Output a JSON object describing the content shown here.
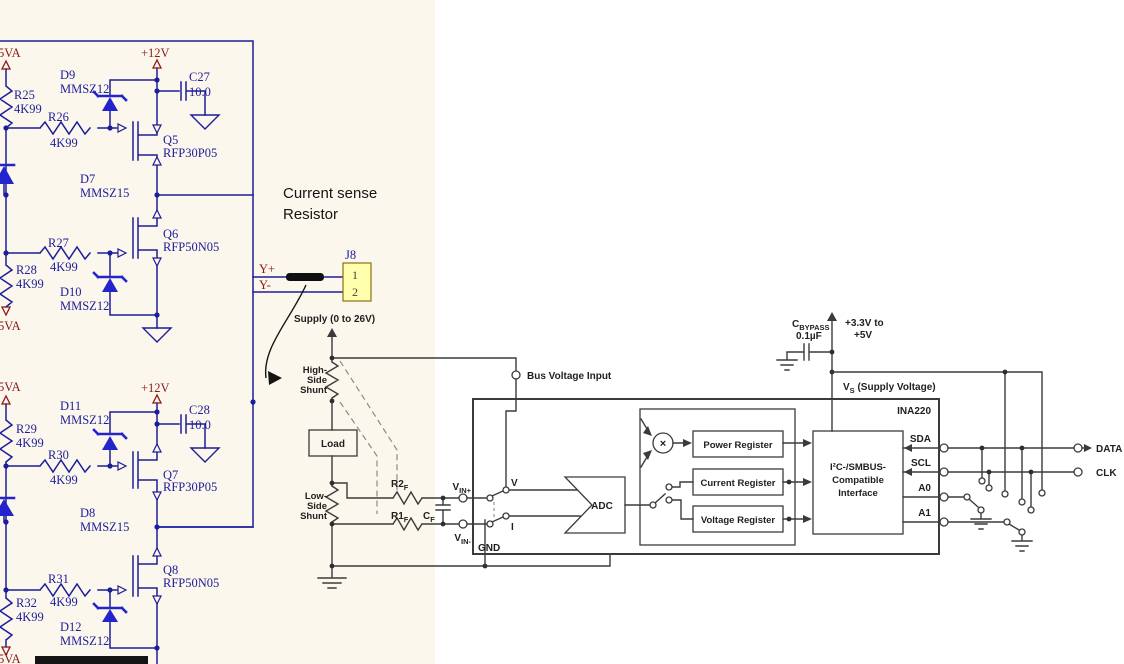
{
  "annotation": {
    "line1": "Current sense",
    "line2": "Resistor"
  },
  "left": {
    "upper": {
      "pwr_top": "5VA",
      "pwr_bottom": "5VA",
      "rail": "+12V",
      "r25_ref": "R25",
      "r25_val": "4K99",
      "r26_ref": "R26",
      "r26_val": "4K99",
      "r27_ref": "R27",
      "r27_val": "4K99",
      "r28_ref": "R28",
      "r28_val": "4K99",
      "d9_ref": "D9",
      "d9_val": "MMSZ12",
      "d7_ref": "D7",
      "d7_val": "MMSZ15",
      "d10_ref": "D10",
      "d10_val": "MMSZ12",
      "c27_ref": "C27",
      "c27_val": "10.0",
      "q5_ref": "Q5",
      "q5_val": "RFP30P05",
      "q6_ref": "Q6",
      "q6_val": "RFP50N05"
    },
    "lower": {
      "pwr_top": "5VA",
      "pwr_bottom": "5VA",
      "rail": "+12V",
      "r29_ref": "R29",
      "r29_val": "4K99",
      "r30_ref": "R30",
      "r30_val": "4K99",
      "r31_ref": "R31",
      "r31_val": "4K99",
      "r32_ref": "R32",
      "r32_val": "4K99",
      "d11_ref": "D11",
      "d11_val": "MMSZ12",
      "d8_ref": "D8",
      "d8_val": "MMSZ15",
      "d12_ref": "D12",
      "d12_val": "MMSZ12",
      "c28_ref": "C28",
      "c28_val": "10.0",
      "q7_ref": "Q7",
      "q7_val": "RFP30P05",
      "q8_ref": "Q8",
      "q8_val": "RFP50N05"
    },
    "j8": {
      "ref": "J8",
      "pin1": "1",
      "pin2": "2",
      "yplus": "Y+",
      "yminus": "Y-"
    }
  },
  "ina220": {
    "supply": "Supply (0 to 26V)",
    "hs1": "High-",
    "hs2": "Side",
    "hs3": "Shunt",
    "ls1": "Low-",
    "ls2": "Side",
    "ls3": "Shunt",
    "load": "Load",
    "r2f_base": "R2",
    "r2f_sub": "F",
    "r1f_base": "R1",
    "r1f_sub": "F",
    "cf_base": "C",
    "cf_sub": "F",
    "vinp_base": "V",
    "vinp_sub": "IN+",
    "vinm_base": "V",
    "vinm_sub": "IN-",
    "bus_input": "Bus Voltage Input",
    "v": "V",
    "i": "I",
    "gnd": "GND",
    "adc": "ADC",
    "mult": "×",
    "reg_power": "Power Register",
    "reg_current": "Current Register",
    "reg_voltage": "Voltage Register",
    "if1": "I²C-/SMBUS-",
    "if2": "Compatible",
    "if3": "Interface",
    "chip": "INA220",
    "sda": "SDA",
    "scl": "SCL",
    "a0": "A0",
    "a1": "A1",
    "data": "DATA",
    "clk": "CLK",
    "cbyp_base": "C",
    "cbyp_sub": "BYPASS",
    "cbyp_val": "0.1µF",
    "range1": "+3.3V to",
    "range2": "+5V",
    "vs_base": "V",
    "vs_sub": "S",
    "vs_rest": " (Supply Voltage)"
  },
  "colors": {
    "cream": "#fcf7ec",
    "navy": "#1d1d99",
    "diode_blue": "#2424cc",
    "maroon": "#8a1a1a",
    "ink": "#3b3b3b",
    "connector_fill": "#ffffad"
  }
}
